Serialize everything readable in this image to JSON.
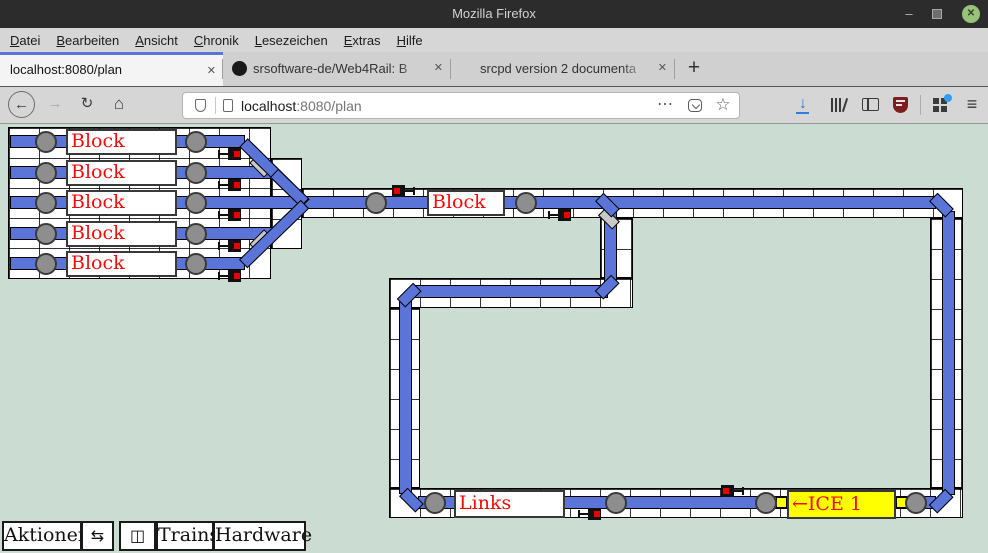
{
  "window": {
    "title": "Mozilla Firefox",
    "minimize_glyph": "–",
    "close_glyph": "✕"
  },
  "menubar": {
    "items": [
      {
        "label": "Datei"
      },
      {
        "label": "Bearbeiten"
      },
      {
        "label": "Ansicht"
      },
      {
        "label": "Chronik"
      },
      {
        "label": "Lesezeichen"
      },
      {
        "label": "Extras"
      },
      {
        "label": "Hilfe"
      }
    ]
  },
  "tabbar": {
    "tabs": [
      {
        "title": "localhost:8080/plan",
        "active": true
      },
      {
        "title": "srsoftware-de/Web4Rail: B",
        "icon": "github"
      },
      {
        "title": "srcpd version 2 documenta",
        "icon": null
      }
    ],
    "new_tab_glyph": "+",
    "close_glyph": "✕"
  },
  "navbar": {
    "back_glyph": "←",
    "forward_glyph": "→",
    "reload_glyph": "↻",
    "home_glyph": "⌂",
    "url_host": "localhost",
    "url_path": ":8080/plan",
    "overflow_glyph": "⋯",
    "bookmark_glyph": "☆",
    "menu_glyph": "≡",
    "download_glyph": "↓"
  },
  "plan": {
    "station_blocks": [
      {
        "label": "Block"
      },
      {
        "label": "Block"
      },
      {
        "label": "Block"
      },
      {
        "label": "Block"
      },
      {
        "label": "Block"
      }
    ],
    "main_block": {
      "label": "Block"
    },
    "links_block": {
      "label": "Links"
    },
    "train_block": {
      "label": "←ICE 1"
    }
  },
  "toolbar": {
    "buttons": [
      {
        "label": "Aktionen"
      },
      {
        "label": "⇆"
      },
      {
        "label": "◫"
      },
      {
        "label": "Trains"
      },
      {
        "label": "Hardware"
      }
    ]
  },
  "colors": {
    "track_blue": "#5b74d8",
    "tab_accent": "#5b74d8",
    "label_red": "#f90808",
    "train_yellow": "#ffff00",
    "page_bg": "#cbdcd2",
    "signal_red": "#ee0000",
    "sensor_gray": "#8e8e8e",
    "switch_gray": "#c9c9c9",
    "ublock_red": "#7d1d1d",
    "close_green": "#98c379",
    "download_blue": "#2f7de1",
    "notify_blue": "#2e9fff"
  }
}
